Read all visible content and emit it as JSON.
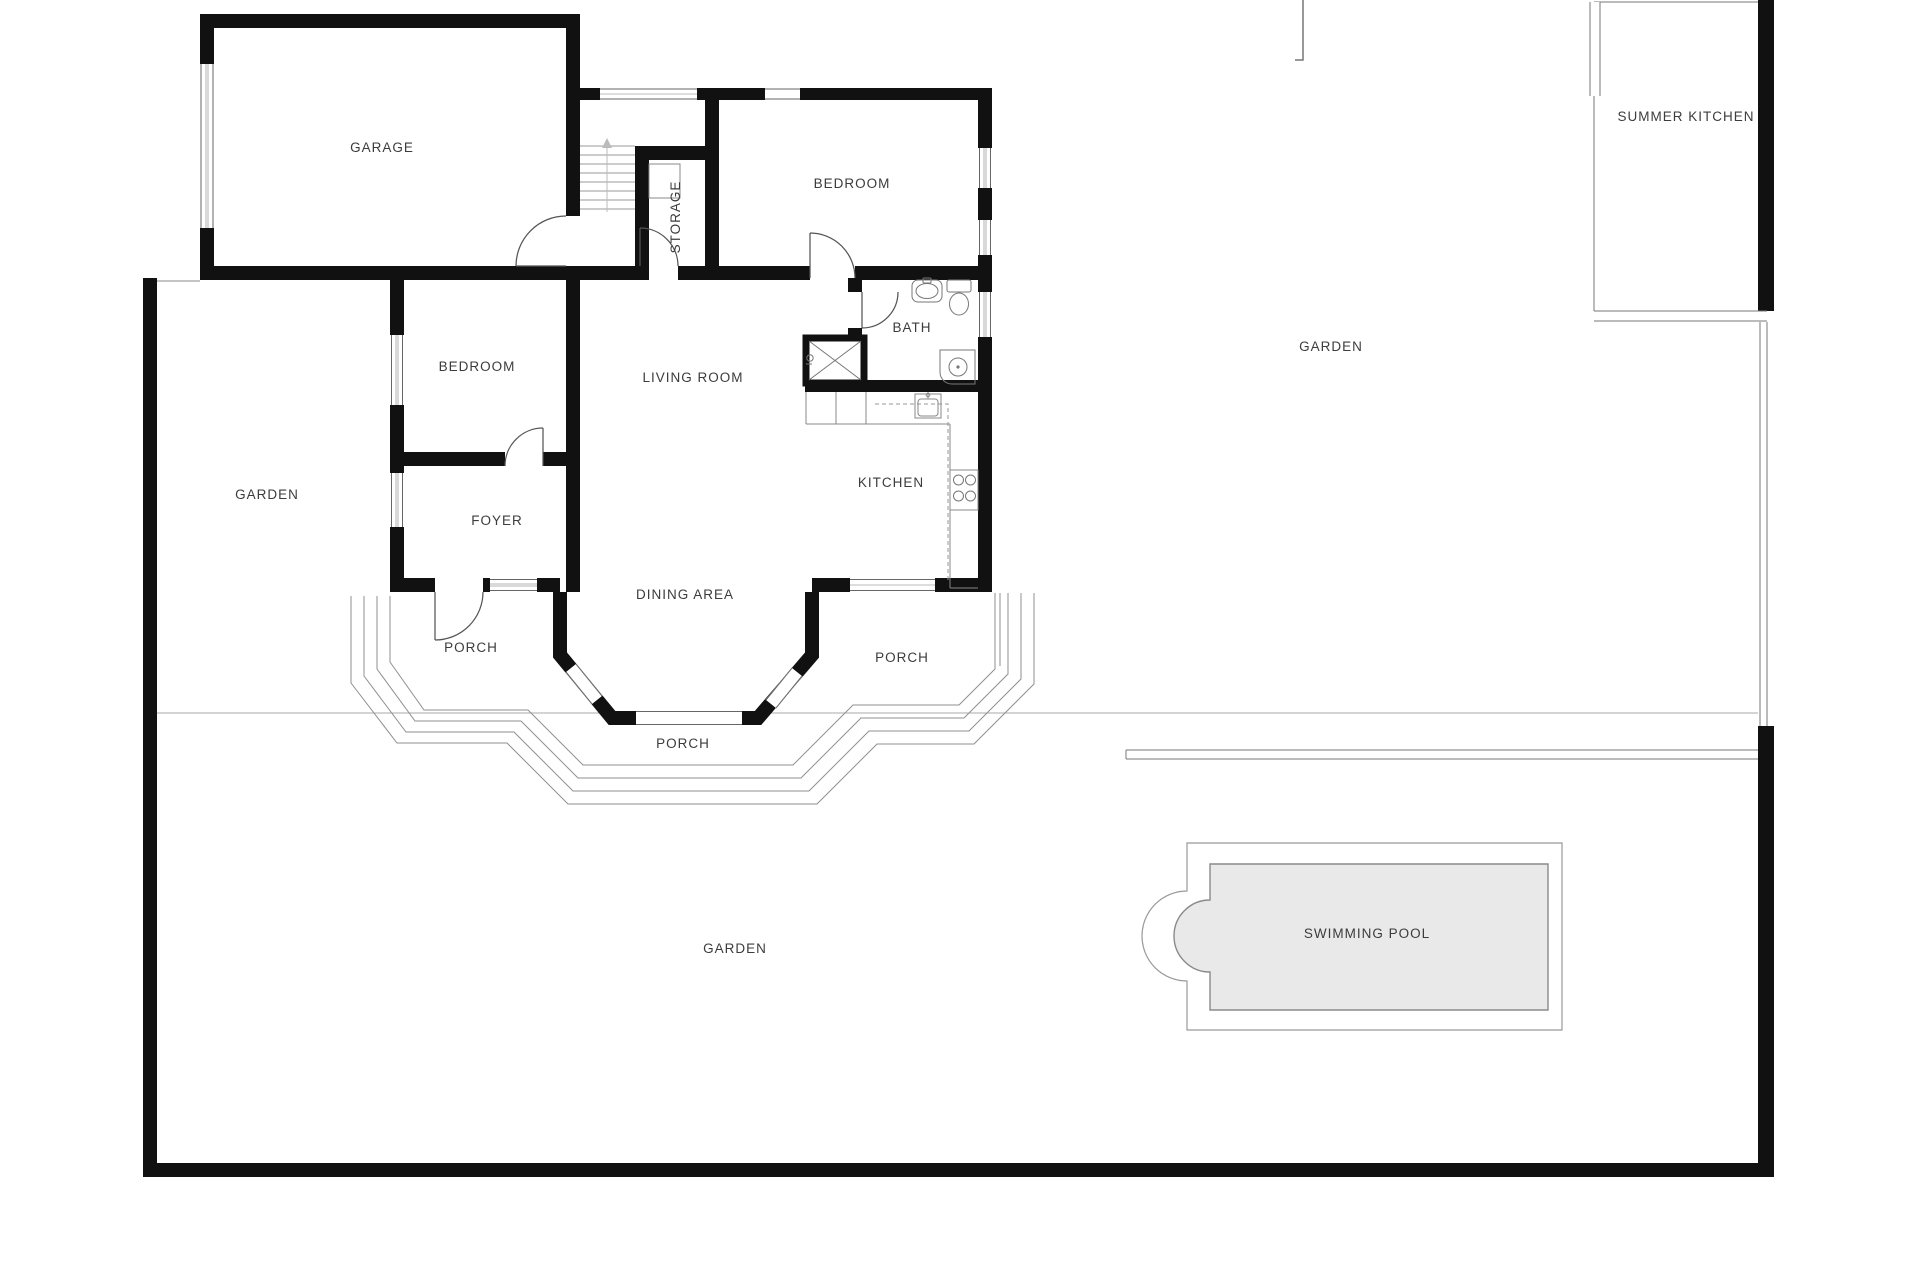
{
  "rooms": [
    {
      "id": "garage",
      "label": "GARAGE",
      "x": 382,
      "y": 152
    },
    {
      "id": "bedroom-top",
      "label": "BEDROOM",
      "x": 852,
      "y": 188
    },
    {
      "id": "storage",
      "label": "STORAGE",
      "x": 676,
      "y": 217,
      "rotate": -90
    },
    {
      "id": "bath",
      "label": "BATH",
      "x": 912,
      "y": 332
    },
    {
      "id": "living-room",
      "label": "LIVING ROOM",
      "x": 693,
      "y": 382
    },
    {
      "id": "bedroom-left",
      "label": "BEDROOM",
      "x": 477,
      "y": 371
    },
    {
      "id": "garden-left",
      "label": "GARDEN",
      "x": 267,
      "y": 499
    },
    {
      "id": "foyer",
      "label": "FOYER",
      "x": 497,
      "y": 525
    },
    {
      "id": "kitchen",
      "label": "KITCHEN",
      "x": 891,
      "y": 487
    },
    {
      "id": "dining-area",
      "label": "DINING AREA",
      "x": 685,
      "y": 599
    },
    {
      "id": "porch-left",
      "label": "PORCH",
      "x": 471,
      "y": 652
    },
    {
      "id": "porch-right",
      "label": "PORCH",
      "x": 902,
      "y": 662
    },
    {
      "id": "porch-bottom",
      "label": "PORCH",
      "x": 683,
      "y": 748
    },
    {
      "id": "garden-right",
      "label": "GARDEN",
      "x": 1331,
      "y": 351
    },
    {
      "id": "summer-kitchen",
      "label": "SUMMER KITCHEN",
      "x": 1686,
      "y": 121
    },
    {
      "id": "swimming-pool",
      "label": "SWIMMING POOL",
      "x": 1367,
      "y": 938
    },
    {
      "id": "garden-bottom",
      "label": "GARDEN",
      "x": 735,
      "y": 953
    }
  ],
  "colors": {
    "wall": "#111111",
    "thin_line": "#888888",
    "step_line": "#8f8f8f",
    "terrace_line": "#aaaaaa",
    "door_line": "#555555",
    "window_glass": "#d9d9d9",
    "pool_fill": "#e9e9e9",
    "pool_border": "#8a8a8a",
    "label": "#3c3c3c",
    "background": "#ffffff"
  }
}
